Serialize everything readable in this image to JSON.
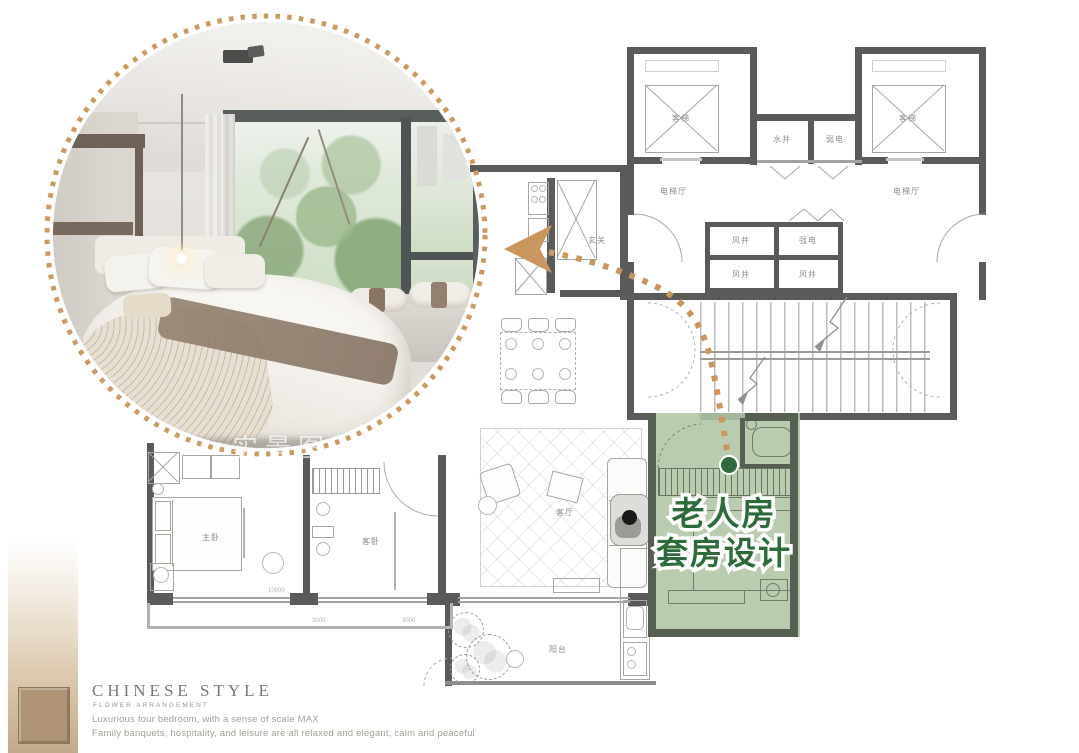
{
  "photo": {
    "watermark": "实景图"
  },
  "floor_plan": {
    "labels": {
      "elevator_left": "客梯",
      "elevator_right": "客梯",
      "water_shaft": "水井",
      "weak_electric": "弱电",
      "hall_left": "电梯厅",
      "hall_right": "电梯厅",
      "wind_shaft_1": "风井",
      "strong_electric": "强电",
      "wind_shaft_2": "风井",
      "wind_shaft_3": "风井",
      "entrance": "玄关",
      "living_room": "客厅",
      "balcony": "阳台",
      "master_bedroom": "主卧",
      "guest_bedroom": "客卧"
    },
    "dimensions": {
      "d1": "10000",
      "d2": "3000",
      "d3": "3000"
    },
    "wall_color": "#5A5A58"
  },
  "suite_callout": {
    "line1": "老人房",
    "line2": "套房设计",
    "text_color": "#2D6B3A",
    "overlay_color": "#B0C5A5",
    "dot_color": "#2E6B3F"
  },
  "arrow": {
    "color": "#C9975E"
  },
  "footer": {
    "brand": "CHINESE STYLE",
    "brand_sub": "FLOWER ARRANGEMENT",
    "tagline_line1": "Luxurious four bedroom, with a sense of scale MAX",
    "tagline_line2": "Family banquets, hospitality, and leisure are all relaxed and elegant, calm and peaceful"
  }
}
